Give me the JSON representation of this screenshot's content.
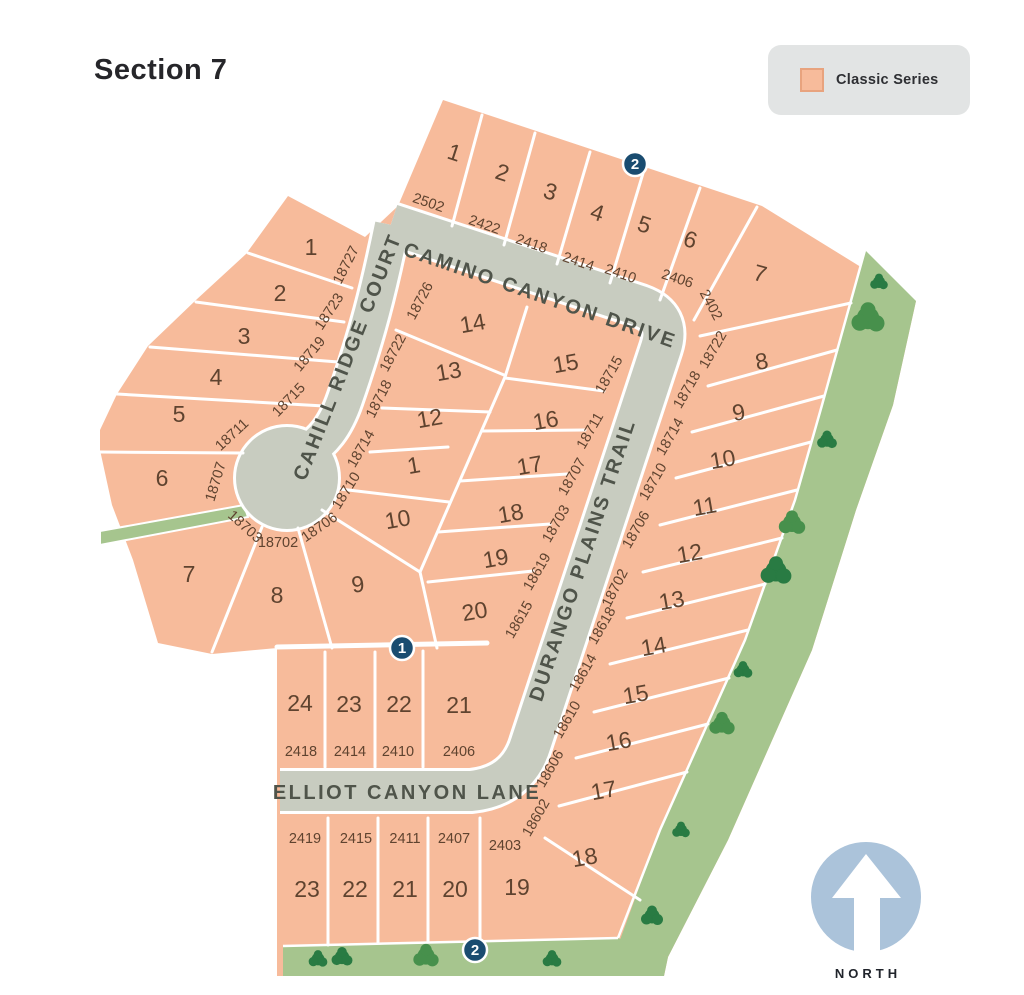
{
  "title": "Section 7",
  "legend": {
    "label": "Classic Series"
  },
  "north": {
    "label": "NORTH"
  },
  "streets": {
    "camino": "CAMINO CANYON DRIVE",
    "cahill": "CAHILL RIDGE COURT",
    "durango": "DURANGO PLAINS TRAIL",
    "elliot": "ELLIOT CANYON LANE"
  },
  "markers": {
    "top": "2",
    "mid": "1",
    "bottom": "2"
  },
  "blocks": {
    "top": [
      {
        "n": "1",
        "a": "2502"
      },
      {
        "n": "2",
        "a": "2422"
      },
      {
        "n": "3",
        "a": "2418"
      },
      {
        "n": "4",
        "a": "2414"
      },
      {
        "n": "5",
        "a": "2410"
      },
      {
        "n": "6",
        "a": "2406"
      },
      {
        "n": "7",
        "a": "2402"
      }
    ],
    "west": [
      {
        "n": "1",
        "a": "18727"
      },
      {
        "n": "2",
        "a": "18723"
      },
      {
        "n": "3",
        "a": "18719"
      },
      {
        "n": "4",
        "a": "18715"
      },
      {
        "n": "5",
        "a": "18711"
      },
      {
        "n": "6",
        "a": "18707"
      },
      {
        "n": "7",
        "a": "18703"
      }
    ],
    "cahill_east": [
      {
        "n": "8",
        "a": "18702"
      },
      {
        "n": "9",
        "a": "18706"
      },
      {
        "n": "10",
        "a": "18710"
      },
      {
        "n": "1",
        "a": "18714"
      },
      {
        "n": "12",
        "a": "18718"
      },
      {
        "n": "13",
        "a": "18722"
      },
      {
        "n": "14",
        "a": "18726"
      }
    ],
    "durango_west": [
      {
        "n": "15",
        "a": "18715"
      },
      {
        "n": "16",
        "a": "18711"
      },
      {
        "n": "17",
        "a": "18707"
      },
      {
        "n": "18",
        "a": "18703"
      },
      {
        "n": "19",
        "a": "18619"
      },
      {
        "n": "20",
        "a": "18615"
      }
    ],
    "durango_east": [
      {
        "n": "8",
        "a": "18722"
      },
      {
        "n": "9",
        "a": "18718"
      },
      {
        "n": "10",
        "a": "18714"
      },
      {
        "n": "11",
        "a": "18710"
      },
      {
        "n": "12",
        "a": "18706"
      },
      {
        "n": "13",
        "a": "18702"
      },
      {
        "n": "14",
        "a": "18618"
      },
      {
        "n": "15",
        "a": "18614"
      },
      {
        "n": "16",
        "a": "18610"
      },
      {
        "n": "17",
        "a": "18606"
      },
      {
        "n": "18",
        "a": "18602"
      }
    ],
    "elliot_north": [
      {
        "n": "24",
        "a": "2418"
      },
      {
        "n": "23",
        "a": "2414"
      },
      {
        "n": "22",
        "a": "2410"
      },
      {
        "n": "21",
        "a": "2406"
      }
    ],
    "elliot_south": [
      {
        "n": "23",
        "a": "2419"
      },
      {
        "n": "22",
        "a": "2415"
      },
      {
        "n": "21",
        "a": "2411"
      },
      {
        "n": "20",
        "a": "2407"
      },
      {
        "n": "19",
        "a": "2403"
      }
    ]
  },
  "colors": {
    "lot_fill": "#F7BB9B",
    "lot_line": "#FFFFFF",
    "street": "#C8CCC0",
    "street_text": "#4F544A",
    "green_space": "#A6C58E",
    "tree_dark": "#297B43",
    "tree_mid": "#47904C",
    "text_brown": "#5F432F",
    "marker_bg": "#1A4C70",
    "marker_text": "#FFFFFF",
    "legend_bg": "#E2E4E4",
    "legend_swatch_border": "#E8A37E",
    "north_blue": "#ABC3DA",
    "title_text": "#26262A",
    "page_bg": "#FFFFFF"
  }
}
